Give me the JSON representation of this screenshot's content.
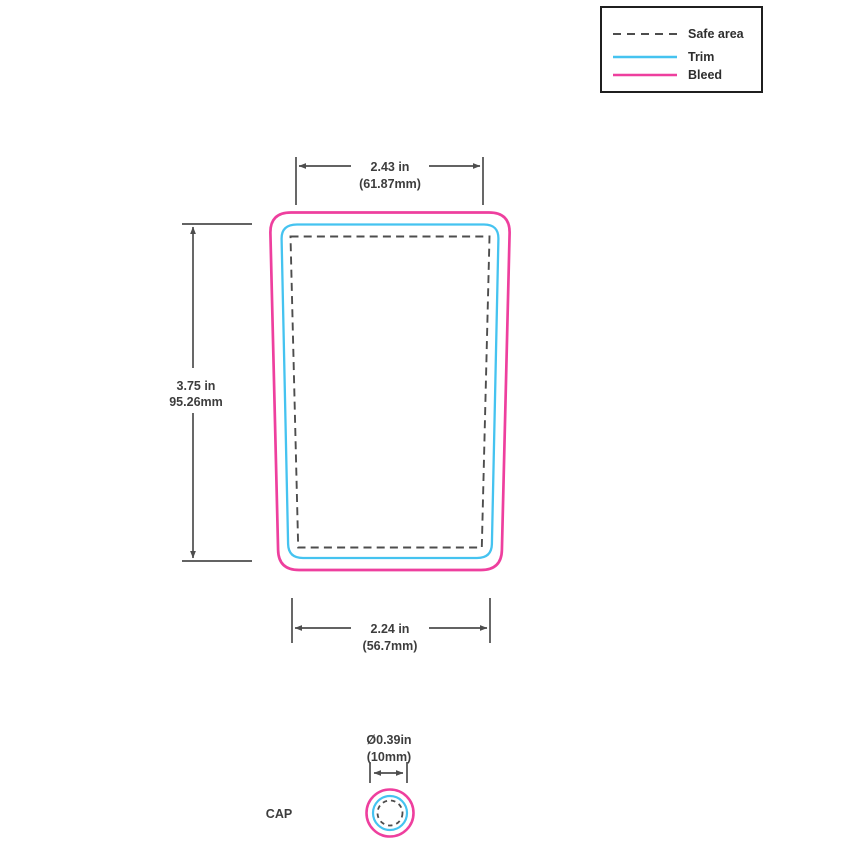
{
  "legend": {
    "items": [
      {
        "label": "Safe area",
        "style": "dashed",
        "color_key": "safe"
      },
      {
        "label": "Trim",
        "style": "solid",
        "color_key": "trim"
      },
      {
        "label": "Bleed",
        "style": "solid",
        "color_key": "bleed"
      }
    ]
  },
  "dimensions": {
    "top": {
      "inches": "2.43 in",
      "mm": "(61.87mm)"
    },
    "left": {
      "inches": "3.75 in",
      "mm": "95.26mm"
    },
    "bottom": {
      "inches": "2.24 in",
      "mm": "(56.7mm)"
    },
    "cap": {
      "inches": "Ø0.39in",
      "mm": "(10mm)"
    }
  },
  "labels": {
    "cap": "CAP"
  },
  "colors": {
    "bleed": "#ee3f9e",
    "trim": "#45c3f0",
    "safe": "#4d4d4d",
    "dim": "#4d4d4d",
    "text": "#3d3d3d"
  }
}
